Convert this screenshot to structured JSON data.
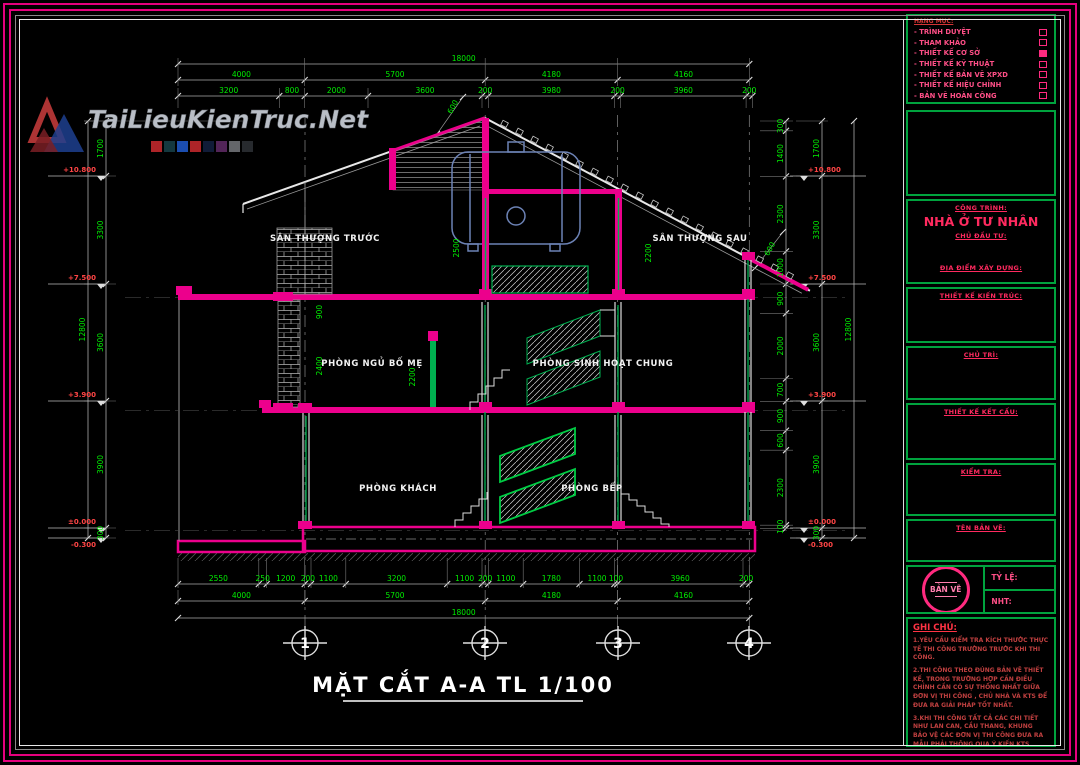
{
  "watermark": {
    "text": "TaiLieuKienTruc.Net"
  },
  "legend": {
    "title": "HẠNG MỤC:",
    "items": [
      {
        "label": "TRÌNH DUYỆT",
        "checked": false
      },
      {
        "label": "THAM KHẢO",
        "checked": false
      },
      {
        "label": "THIẾT KẾ CƠ SỞ",
        "checked": true
      },
      {
        "label": "THIẾT KẾ KỸ THUẬT",
        "checked": false
      },
      {
        "label": "THIẾT KẾ BẢN VẼ XPXD",
        "checked": false
      },
      {
        "label": "THIẾT KẾ HIỆU CHỈNH",
        "checked": false
      },
      {
        "label": "BẢN VẼ HOÀN CÔNG",
        "checked": false
      }
    ]
  },
  "title_block": {
    "project_label": "CÔNG TRÌNH:",
    "project_name": "NHÀ Ở TƯ NHÂN",
    "client_label": "CHỦ ĐẦU TƯ:",
    "location_label": "ĐỊA ĐIỂM XÂY DỰNG:",
    "architect_label": "THIẾT KẾ KIẾN TRÚC:",
    "lead_label": "CHỦ TRÌ:",
    "structural_label": "THIẾT KẾ KẾT CẤU:",
    "check_label": "KIỂM TRA:",
    "sheet_name_label": "TÊN BẢN VẼ:",
    "stamp_text": "BẢN VẼ",
    "scale_label": "TỶ LỆ:",
    "sheet_no_label": "NHT:",
    "notes_title": "GHI CHÚ:",
    "notes": [
      "1.YÊU CẦU KIỂM TRA KÍCH THƯỚC THỰC TẾ THI CÔNG TRƯỜNG TRƯỚC KHI THI CÔNG.",
      "2.THI CÔNG THEO ĐÚNG BẢN VẼ THIẾT KẾ, TRONG TRƯỜNG HỢP CẦN ĐIỀU CHỈNH CẦN CÓ SỰ THỐNG NHẤT GIỮA ĐƠN VỊ THI CÔNG , CHỦ NHÀ VÀ KTS ĐỂ ĐƯA RA GIẢI PHÁP TỐT NHẤT.",
      "3.KHI THI CÔNG TẤT CẢ CÁC CHI TIẾT NHƯ LAN CAN, CẦU THANG, KHUNG BẢO VỆ CÁC ĐƠN VỊ THI CÔNG ĐƯA RA MẪU PHẢI THÔNG QUA Ý KIẾN KTS HOẶC LÀM THEO MẪU KTS ĐƯA RA."
    ]
  },
  "drawing": {
    "title": "MẶT CẮT A-A  TL 1/100",
    "grid_bubbles": [
      "1",
      "2",
      "3",
      "4"
    ],
    "rooms": {
      "terrace_front": "SÂN THƯỢNG TRƯỚC",
      "terrace_rear": "SÂN THƯỢNG SAU",
      "bedroom": "PHÒNG NGỦ BỐ MẸ",
      "living_common": "PHÒNG SINH HOẠT CHUNG",
      "living_room": "PHÒNG KHÁCH",
      "kitchen": "PHÒNG BẾP"
    },
    "dims": {
      "top_total": "18000",
      "top_row2": [
        "4000",
        "5700",
        "4180",
        "4160"
      ],
      "top_row3": [
        "3200",
        "800",
        "2000",
        "3600",
        "200",
        "3980",
        "200",
        "3960",
        "200"
      ],
      "bottom_row1": [
        "2550",
        "250",
        "1200",
        "200",
        "1100",
        "3200",
        "1100",
        "200",
        "1100",
        "1780",
        "1100",
        "100",
        "3960",
        "200"
      ],
      "bottom_row2": [
        "4000",
        "5700",
        "4180",
        "4160"
      ],
      "bottom_total": "18000",
      "left_chain": [
        "1700",
        "3300",
        "3600",
        "3900",
        "300"
      ],
      "left_total": "12800",
      "right_inner": [
        "300",
        "1400",
        "2300",
        "1000",
        "900",
        "2000",
        "700",
        "900",
        "600",
        "2300",
        "100"
      ],
      "right_chain": [
        "1700",
        "3300",
        "3600",
        "3900",
        "300"
      ],
      "right_total": "12800",
      "levels": [
        "+10.800",
        "+7.500",
        "+3.900",
        "±0.000",
        "-0.300"
      ],
      "roof_dim_left": "600",
      "roof_dim_right": "600",
      "interior": [
        "900",
        "2500",
        "2200",
        "2400",
        "2200"
      ]
    }
  }
}
